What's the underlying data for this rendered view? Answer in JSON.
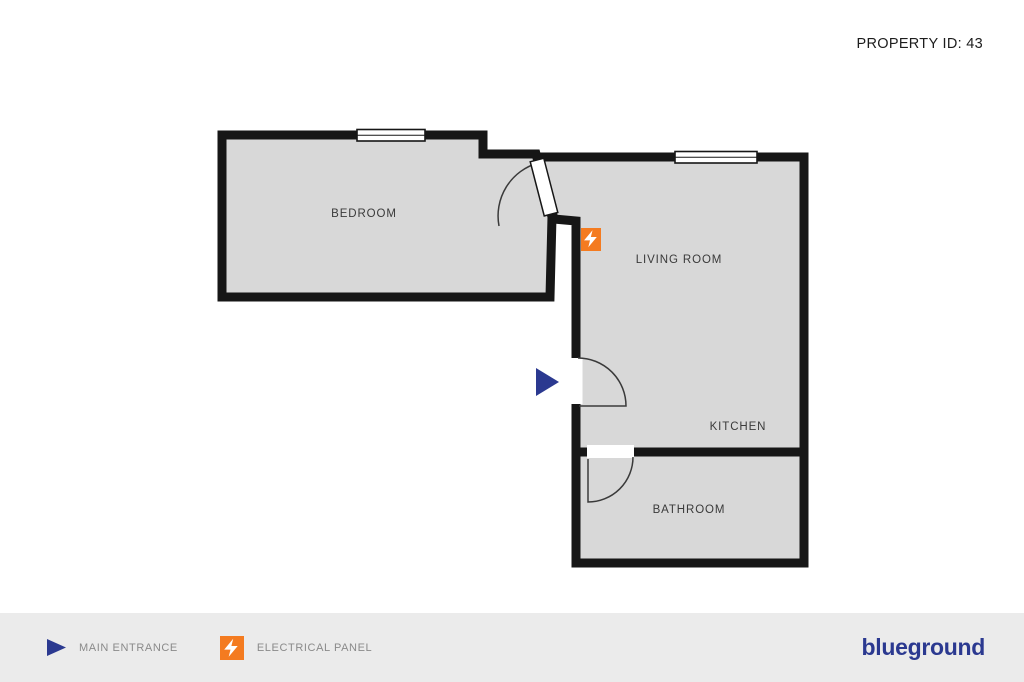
{
  "header": {
    "property_id": "PROPERTY ID: 43"
  },
  "floor_plan": {
    "rooms": [
      {
        "id": "bedroom",
        "label": "BEDROOM"
      },
      {
        "id": "living-room",
        "label": "LIVING ROOM"
      },
      {
        "id": "kitchen",
        "label": "KITCHEN"
      },
      {
        "id": "bathroom",
        "label": "BATHROOM"
      }
    ],
    "features": [
      {
        "icon": "electrical-panel-icon",
        "location": "living-room"
      },
      {
        "icon": "main-entrance-arrow-icon",
        "location": "living-room-left-wall"
      }
    ]
  },
  "legend": {
    "items": [
      {
        "icon": "main-entrance-arrow-icon",
        "label": "MAIN ENTRANCE"
      },
      {
        "icon": "electrical-panel-icon",
        "label": "ELECTRICAL PANEL"
      }
    ],
    "brand": "blueground"
  },
  "colors": {
    "wall": "#161616",
    "room_fill": "#d8d8d8",
    "accent_orange": "#f47b20",
    "brand_navy": "#2b3990",
    "legend_background": "#ebebeb",
    "room_label": "#3a3a3a",
    "legend_label": "#8a8a8a"
  }
}
